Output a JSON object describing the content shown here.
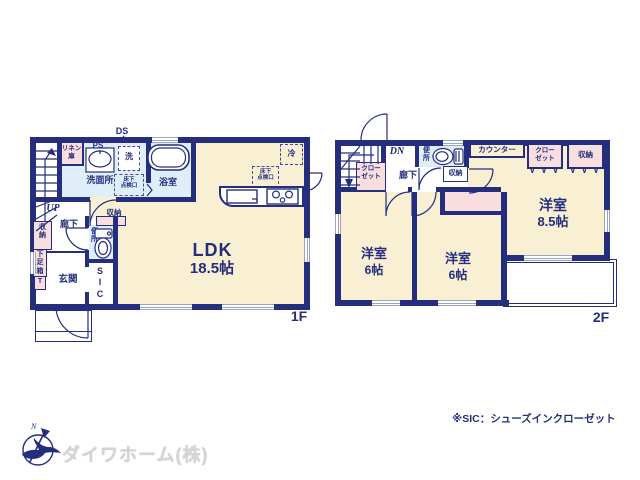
{
  "colors": {
    "wall_navy": "#252e7d",
    "room_cream": "#f9efd3",
    "closet_pink": "#f8dede",
    "wet_blue": "#dfeef8",
    "window_gray": "#9aa5c6",
    "logo_gray": "#d4d4d4"
  },
  "floor1": {
    "label": "1F",
    "ldk_name": "LDK",
    "ldk_size": "18.5帖",
    "washroom": "洗面所",
    "bath": "浴室",
    "linen": "リネン\n庫",
    "ps": "PS",
    "ds": "DS",
    "washer": "洗",
    "fridge": "冷",
    "hatch": "床下\n点検口",
    "up": "UP",
    "hall": "廊下",
    "storage": "収納",
    "toilet": "便\n所",
    "storage_left": "収\n納",
    "shoe_box": "下\n足\n箱",
    "shoe_t": "T",
    "entrance": "玄関",
    "sic": "S\nI\nC"
  },
  "floor2": {
    "label": "2F",
    "dn": "DN",
    "closet_hall": "クロー\nゼット",
    "hall": "廊下",
    "toilet": "便\n所",
    "storage_small": "収納",
    "counter": "カウンター",
    "closet": "クロー\nゼット",
    "storage": "収納",
    "notches": "∨ ∨ ∨",
    "room_main_name": "洋室",
    "room_main_size": "8.5帖",
    "room_left_name": "洋室",
    "room_left_size": "6帖",
    "room_mid_name": "洋室",
    "room_mid_size": "6帖"
  },
  "footer": {
    "company": "ダイワホーム(株)",
    "note": "※SIC：シューズインクローゼット",
    "compass_n": "N"
  }
}
